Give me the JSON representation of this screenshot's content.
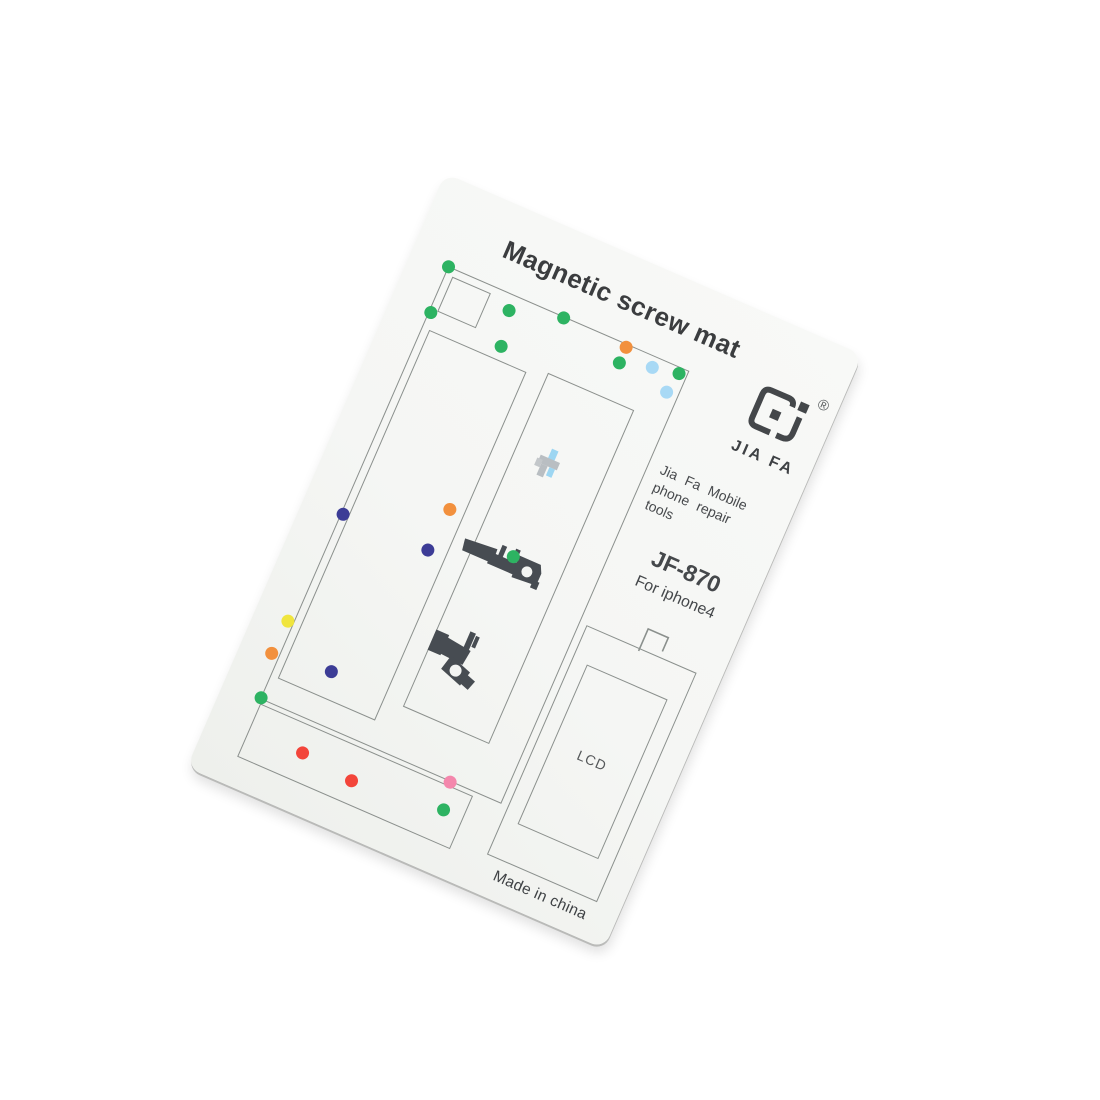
{
  "product": {
    "title": "Magnetic screw mat",
    "brand": "JIA FA",
    "reg_mark": "®",
    "tagline_lines": [
      "Jia Fa Mobile",
      "phone repair",
      "tools"
    ],
    "model": "JF-870",
    "compatibility": "For iphone4",
    "lcd_label": "LCD",
    "origin": "Made in china"
  },
  "palette": {
    "green": "#2db362",
    "orange": "#f2903d",
    "sky": "#a8d9f5",
    "navy": "#3c3c96",
    "yellow": "#f0e53e",
    "red": "#f3453a",
    "pink": "#f487ac",
    "line": "#8b908d",
    "ink": "#3e4144",
    "card": "#f6f7f5"
  },
  "dots": [
    {
      "x": 40,
      "y": 84,
      "color": "green"
    },
    {
      "x": 42,
      "y": 133,
      "color": "green"
    },
    {
      "x": 113,
      "y": 100,
      "color": "green"
    },
    {
      "x": 166,
      "y": 85,
      "color": "green"
    },
    {
      "x": 120,
      "y": 136,
      "color": "green"
    },
    {
      "x": 235,
      "y": 87,
      "color": "orange"
    },
    {
      "x": 235,
      "y": 104,
      "color": "green"
    },
    {
      "x": 267,
      "y": 95,
      "color": "sky"
    },
    {
      "x": 290,
      "y": 112,
      "color": "sky"
    },
    {
      "x": 294,
      "y": 90,
      "color": "green"
    },
    {
      "x": 42,
      "y": 353,
      "color": "navy"
    },
    {
      "x": 138,
      "y": 306,
      "color": "orange"
    },
    {
      "x": 134,
      "y": 352,
      "color": "navy"
    },
    {
      "x": 34,
      "y": 473,
      "color": "yellow"
    },
    {
      "x": 32,
      "y": 509,
      "color": "orange"
    },
    {
      "x": 40,
      "y": 554,
      "color": "green"
    },
    {
      "x": 94,
      "y": 502,
      "color": "navy"
    },
    {
      "x": 100,
      "y": 588,
      "color": "red"
    },
    {
      "x": 156,
      "y": 594,
      "color": "red"
    },
    {
      "x": 247,
      "y": 556,
      "color": "pink"
    },
    {
      "x": 252,
      "y": 584,
      "color": "green"
    },
    {
      "x": 215,
      "y": 324,
      "color": "green"
    }
  ]
}
